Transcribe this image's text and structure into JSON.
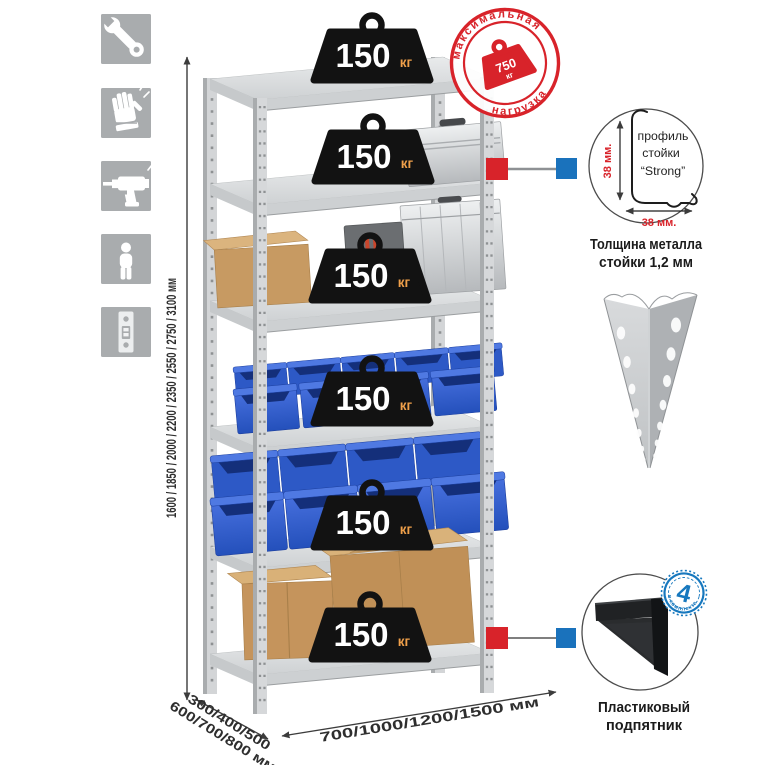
{
  "side_icons": {
    "items": [
      {
        "icon": "wrench-icon"
      },
      {
        "icon": "work-gloves-icon"
      },
      {
        "icon": "drill-icon"
      },
      {
        "icon": "person-height-icon"
      },
      {
        "icon": "rack-post-icon"
      }
    ]
  },
  "dimensions": {
    "height_options": "1600 / 1850 / 2000 / 2200 / 2350 / 2550 / 2750 / 3100 мм",
    "depth_options_line1": "300/400/500",
    "depth_options_line2": "600/700/800 мм",
    "width_options": "700/1000/1200/1500 мм"
  },
  "max_load_stamp": {
    "arc_top": "максимальная",
    "arc_bottom": "нагрузка",
    "value": "750",
    "unit": "кг"
  },
  "shelf_weight": {
    "value": "150",
    "unit": "кг",
    "shelves_count": 6
  },
  "post_profile": {
    "label_line1": "профиль",
    "label_line2": "стойки",
    "label_line3": "“Strong”",
    "dim_vertical": "38 мм.",
    "dim_horizontal": "38 мм.",
    "caption_line1": "Толщина металла",
    "caption_line2": "стойки 1,2 мм"
  },
  "plastic_foot": {
    "badge_count": "4",
    "badge_text": "в комплекте",
    "caption_line1": "Пластиковый",
    "caption_line2": "подпятник"
  },
  "colors": {
    "accent_red": "#d8232a",
    "accent_blue": "#1a72bc",
    "bin_blue": "#2f5fd0",
    "metal_gray": "#ccced0",
    "icon_tile_gray": "#a9acae"
  }
}
